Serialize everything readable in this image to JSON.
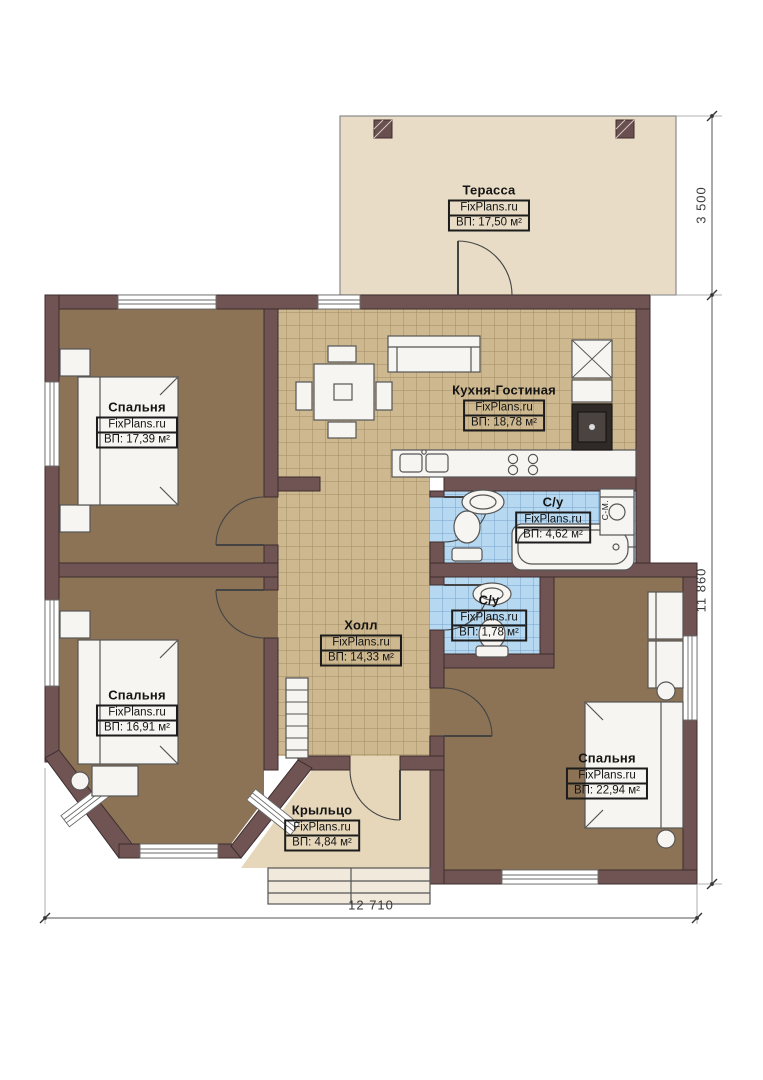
{
  "site": "FixPlans.ru",
  "rooms": [
    {
      "id": "terrace",
      "name": "Терасса",
      "area": "ВП: 17,50 м²"
    },
    {
      "id": "bedroom1",
      "name": "Спальня",
      "area": "ВП: 17,39 м²"
    },
    {
      "id": "kitchen",
      "name": "Кухня-Гостиная",
      "area": "ВП: 18,78 м²"
    },
    {
      "id": "bath1",
      "name": "С/у",
      "area": "ВП: 4,62 м²"
    },
    {
      "id": "hall",
      "name": "Холл",
      "area": "ВП: 14,33 м²"
    },
    {
      "id": "bath2",
      "name": "С/у",
      "area": "ВП: 1,78 м²"
    },
    {
      "id": "bedroom2",
      "name": "Спальня",
      "area": "ВП: 16,91 м²"
    },
    {
      "id": "bedroom3",
      "name": "Спальня",
      "area": "ВП: 22,94 м²"
    },
    {
      "id": "porch",
      "name": "Крыльцо",
      "area": "ВП: 4,84 м²"
    }
  ],
  "dimensions": {
    "terrace_depth": "3 500",
    "right_height": "11 860",
    "bottom_width": "12 710"
  },
  "annotations": {
    "washing_machine": "С-М."
  },
  "palette": {
    "wall": "#705454",
    "wood_floor": "#8c7356",
    "tile_tan": "#cdb88f",
    "tile_blue": "#b6d8f1",
    "terrace": "#e9dcc6",
    "porch": "#e6d7ba"
  }
}
